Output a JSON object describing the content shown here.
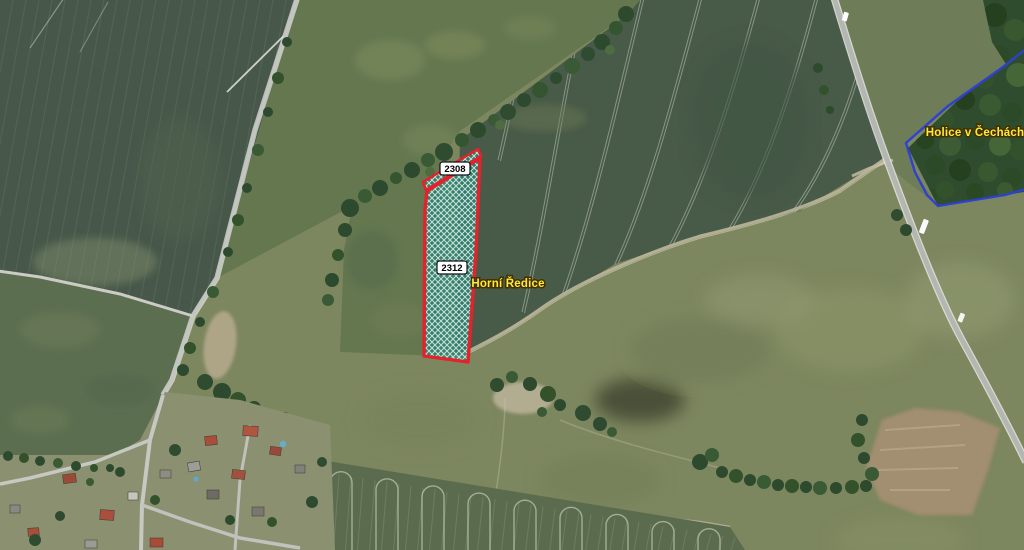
{
  "map": {
    "parcel_labels": [
      {
        "text": "2308"
      },
      {
        "text": "2312"
      }
    ],
    "place_labels": [
      {
        "text": "Horní Ředice"
      },
      {
        "text": "Holice v Čechách"
      }
    ],
    "colors": {
      "parcel_outline": "#e5212b",
      "parcel_fill_teal": "#2f7f70",
      "municipality_boundary_blue": "#2b3fd6",
      "place_label_yellow": "#f8ec3c"
    }
  }
}
